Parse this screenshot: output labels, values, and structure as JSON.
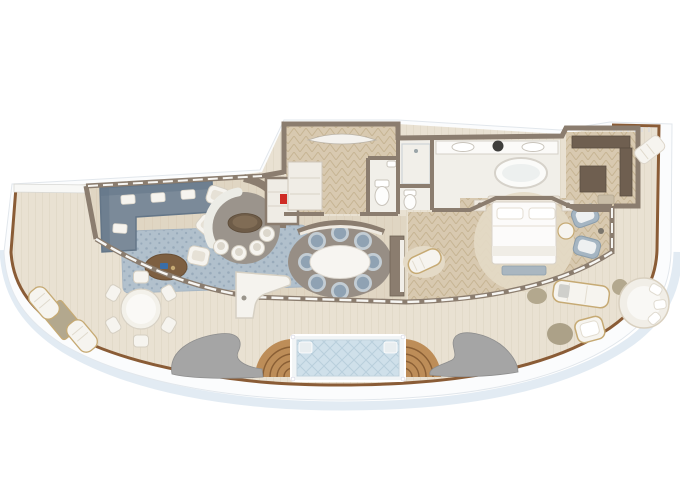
{
  "palette": {
    "bg": "#ffffff",
    "hull_band": "#fbfcfd",
    "hull_edge": "#e2e7ec",
    "hull_shadow": "#dde7f1",
    "wood_rail": "#8a5c36",
    "deck": "#e9e1d2",
    "deck_line": "#dcd2c0",
    "wall": "#8b7d6f",
    "wall_dark": "#6f6355",
    "floor_wood": "#e0d6c3",
    "floor_wood_line": "#d5c9b3",
    "herringbone": "#d8c9b0",
    "herringbone_line": "#c7b594",
    "marble": "#f1efe9",
    "rug_blue": "#aebfcd",
    "rug_blue_dot": "#93a7ba",
    "rug_gray": "#978e85",
    "nook_carpet": "#9b948c",
    "sofa": "#7b8a99",
    "sofa_dark": "#647688",
    "chair_blue": "#8fa2b3",
    "chair_blue_ring": "#c3cdd4",
    "fixture_white": "#f6f4ef",
    "fixture_stroke": "#d5cfc2",
    "table_wood": "#7d5f41",
    "wave_gray": "#a5a5a5",
    "pool_water": "#cfe0ea",
    "pool_grid": "#b9cfdc",
    "pool_frame": "#f2f5f6",
    "teak_step": "#bd8d58",
    "teak_step_line": "#8a5f35",
    "gold_trim": "#c6aa74",
    "ottoman_tan": "#b3a88e",
    "bench_blue": "#a9b6c0",
    "wardrobe": "#6f5f50",
    "wardrobe_dark": "#5b4d40",
    "accent_red": "#cf2b24",
    "bed_linen": "#fcfbfa",
    "rug_cream": "#e4dac6"
  },
  "floorplan": {
    "scene": "Top-down rendering of a ship bow suite with wraparound veranda",
    "rooms": [
      {
        "name": "Living room",
        "furniture": [
          "L-shaped sectional sofa with white pillows",
          "mottled blue area rug",
          "oval wood coffee table",
          "3 white armchairs"
        ]
      },
      {
        "name": "Round breakfast nook",
        "furniture": [
          "curved banquette",
          "oval cocktail table",
          "4 white tub chairs",
          "minibar cabinet"
        ]
      },
      {
        "name": "Entry foyer",
        "furniture": [
          "curved console table",
          "closet with minibar",
          "powder room with toilet"
        ]
      },
      {
        "name": "Dining room",
        "furniture": [
          "oval marble dining table",
          "8 blue upholstered chairs",
          "curved sideboard",
          "storage cabinet"
        ]
      },
      {
        "name": "Master bathroom",
        "furniture": [
          "double vanity with two sinks",
          "freestanding oval bathtub",
          "glass shower room",
          "water closet"
        ]
      },
      {
        "name": "Master bedroom",
        "furniture": [
          "king bed with foot bench",
          "round cream rug",
          "two nightstands",
          "chaise longue",
          "two blue armchairs",
          "round side table"
        ]
      },
      {
        "name": "Walk-in closet",
        "furniture": [
          "wardrobe units",
          "dressing bench"
        ]
      },
      {
        "name": "Wraparound veranda",
        "furniture": [
          "glass plunge pool",
          "curved teak steps",
          "sculptural privacy walls",
          "round dining table with 6 chairs",
          "outdoor bar counter",
          "two sun loungers with table",
          "outdoor sofa",
          "outdoor armchair",
          "ottoman poufs",
          "round daybed",
          "side-deck sun lounger"
        ]
      }
    ]
  }
}
